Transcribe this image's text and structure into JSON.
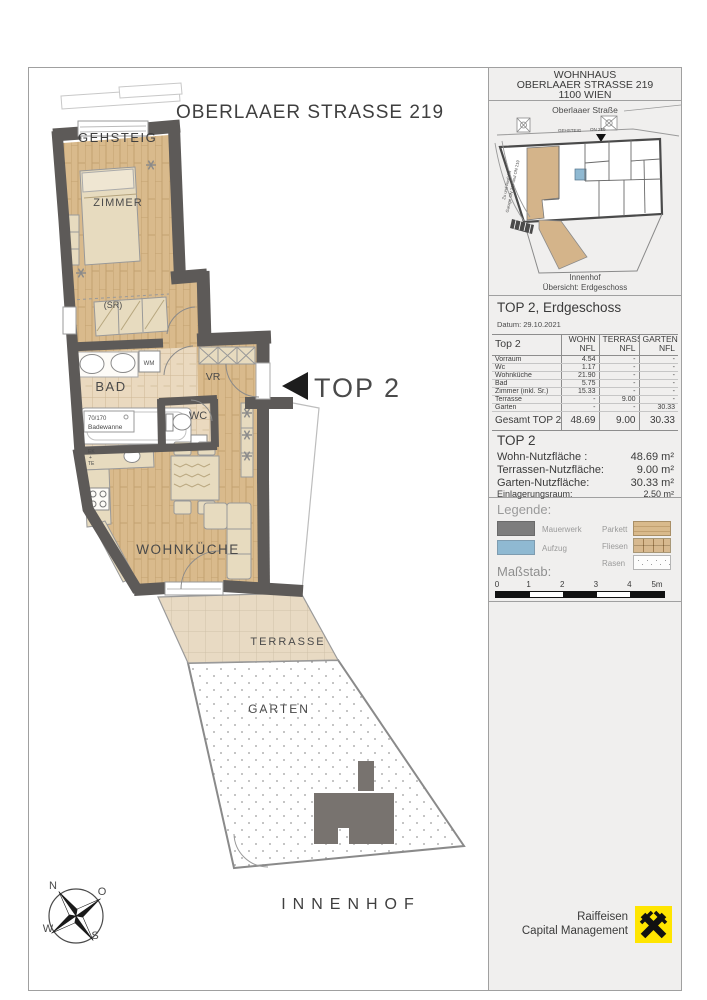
{
  "colors": {
    "wall": "#5d5a58",
    "parquet": "#d9ba8c",
    "tiles": "#ead9bf",
    "terrace": "#e8dac3",
    "furniture": "#e7dbbf",
    "aufzug_blue": "#8fb9d2",
    "raiffeisen_yellow": "#ffe500",
    "panel_bg": "#f0efee"
  },
  "plan": {
    "title": "OBERLAAER STRASSE 219",
    "gehsteig": "GEHSTEIG",
    "innenhof": "INNENHOF",
    "unit_label": "TOP 2",
    "rooms": {
      "zimmer": "ZIMMER",
      "sr": "(SR)",
      "bad": "BAD",
      "wm": "WM",
      "wc": "WC",
      "vr": "VR",
      "wohnkueche": "WOHNKÜCHE",
      "terrasse": "TERRASSE",
      "garten": "GARTEN"
    },
    "bathtub": {
      "size": "70/170",
      "name": "Badewanne"
    },
    "kitchen": {
      "l1": "EK",
      "l2": "+",
      "l3": "TE"
    },
    "compass": {
      "n": "N",
      "o": "O",
      "s": "S",
      "w": "W"
    }
  },
  "info": {
    "header": {
      "l1": "WOHNHAUS",
      "l2": "OBERLAAER STRASSE 219",
      "l3": "1100 WIEN"
    },
    "map": {
      "street": "Oberlaaer Straße",
      "gehsteig": "GEHSTEIG",
      "on": "ON 219",
      "side1": "Zu und Ausfahrt",
      "side2": "Garage ON 217 und ON 219",
      "innenhof": "Innenhof",
      "caption": "Übersicht: Erdgeschoss"
    },
    "section": {
      "title": "TOP 2, Erdgeschoss",
      "date": "Datum: 29.10.2021"
    },
    "table": {
      "c0": "Top 2",
      "cols": [
        {
          "a": "WOHN",
          "b": "NFL"
        },
        {
          "a": "TERRASSE",
          "b": "NFL"
        },
        {
          "a": "GARTEN",
          "b": "NFL"
        }
      ],
      "rows": [
        [
          "Vorraum",
          "4.54",
          "-",
          "-"
        ],
        [
          "Wc",
          "1.17",
          "-",
          "-"
        ],
        [
          "Wohnküche",
          "21.90",
          "-",
          "-"
        ],
        [
          "Bad",
          "5.75",
          "-",
          "-"
        ],
        [
          "Zimmer (inkl. Sr.)",
          "15.33",
          "-",
          "-"
        ],
        [
          "Terrasse",
          "-",
          "9.00",
          "-"
        ],
        [
          "Garten",
          "-",
          "-",
          "30.33"
        ]
      ],
      "total": [
        "Gesamt TOP 2",
        "48.69",
        "9.00",
        "30.33"
      ]
    },
    "summary": {
      "title": "TOP 2",
      "rows": [
        {
          "label": "Wohn-Nutzfläche :",
          "value": "48.69 m²"
        },
        {
          "label": "Terrassen-Nutzfläche:",
          "value": "9.00 m²"
        },
        {
          "label": "Garten-Nutzfläche:",
          "value": "30.33 m²"
        },
        {
          "label": "Einlagerungsraum:",
          "value": "2.50 m²"
        }
      ]
    },
    "legend": {
      "title": "Legende:",
      "mauerwerk": "Mauerwerk",
      "aufzug": "Aufzug",
      "parkett": "Parkett",
      "fliesen": "Fliesen",
      "rasen": "Rasen"
    },
    "scale": {
      "title": "Maßstab:",
      "ticks": [
        "0",
        "1",
        "2",
        "3",
        "4",
        "5m"
      ]
    },
    "logo": {
      "l1": "Raiffeisen",
      "l2": "Capital Management"
    }
  }
}
